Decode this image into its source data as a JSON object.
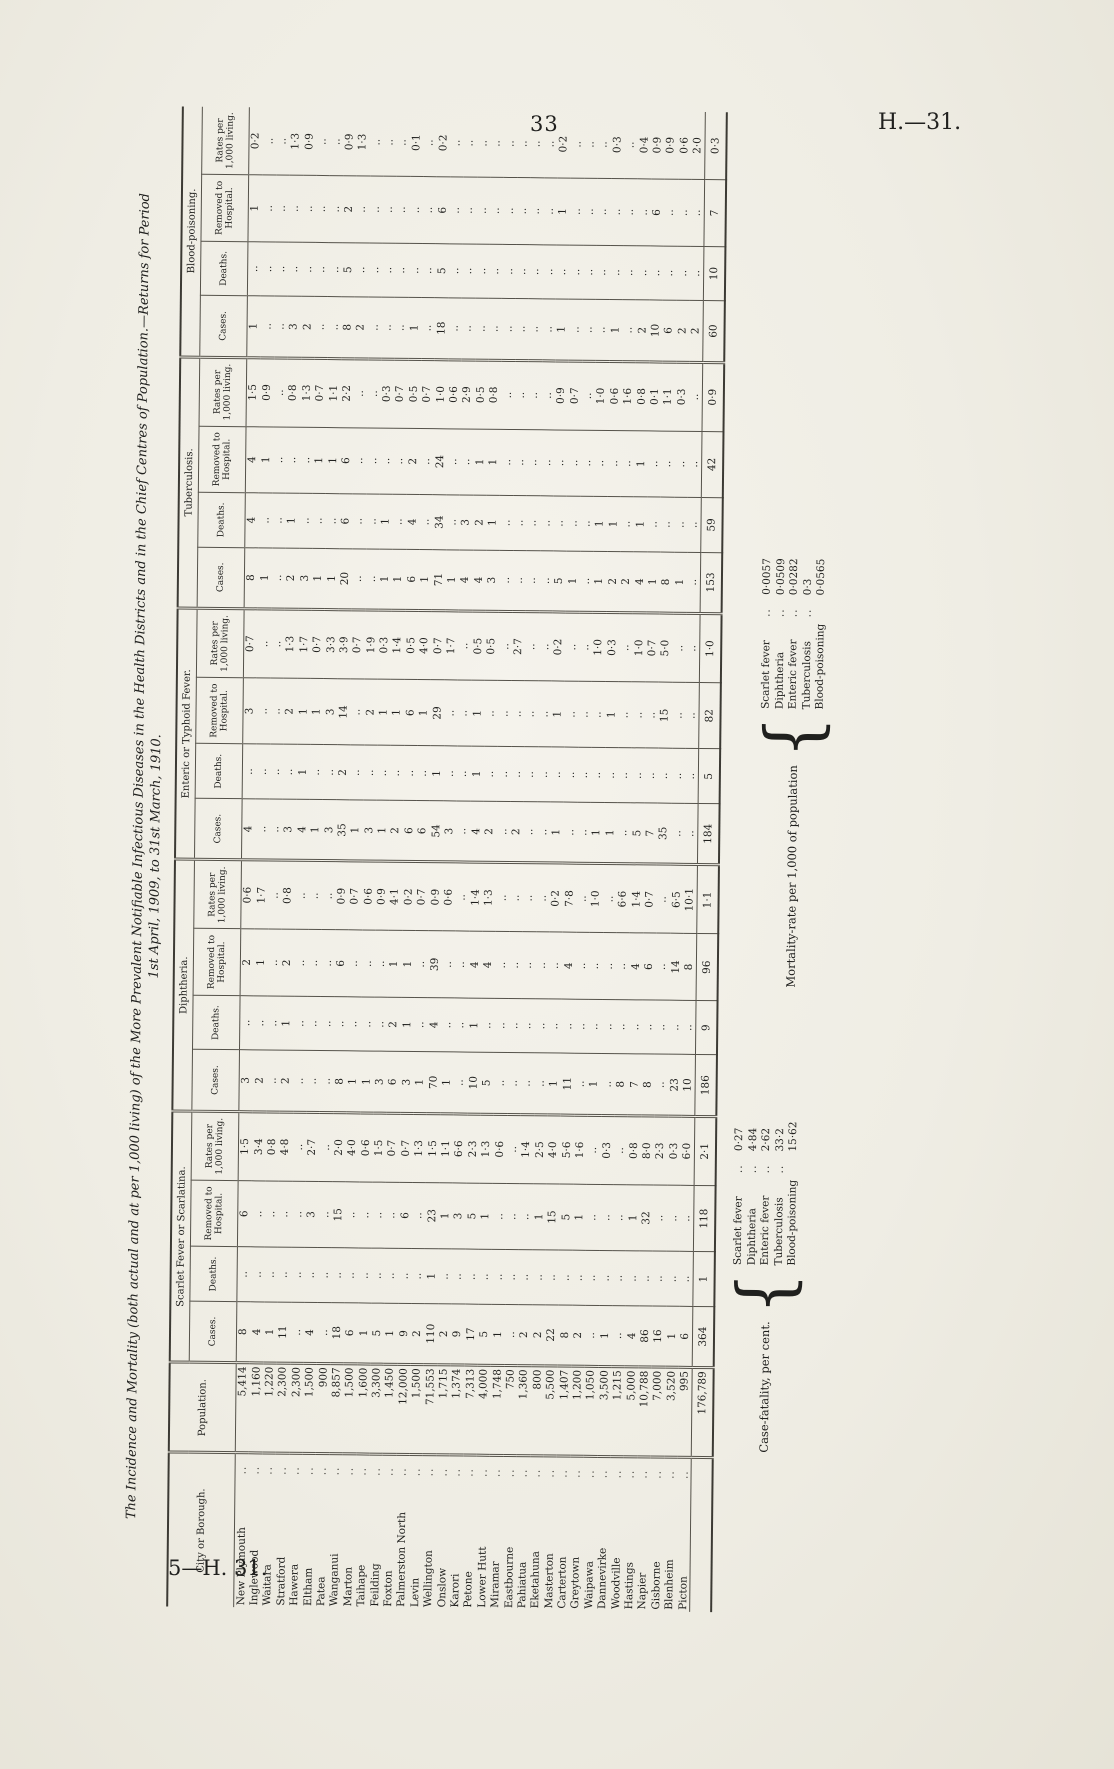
{
  "page": {
    "number": "33",
    "doc_ref": "H.—31.",
    "footer_ref": "5—H. 31."
  },
  "title": {
    "line1": "The Incidence and Mortality (both actual and at per 1,000 living) of the More Prevalent Notifiable Infectious Diseases in the Health Districts and in the Chief Centres of Population.—Returns for Period",
    "line2": "1st April, 1909, to 31st March, 1910."
  },
  "table": {
    "col_headers": {
      "city": "City or Borough.",
      "population": "Population."
    },
    "disease_groups": [
      "Scarlet Fever or Scarlatina.",
      "Diphtheria.",
      "Enteric or Typhoid Fever.",
      "Tuberculosis.",
      "Blood-poisoning."
    ],
    "sub_headers": [
      "Cases.",
      "Deaths.",
      "Removed to Hospital.",
      "Rates per 1,000 living."
    ],
    "leader_dots": "..",
    "blank_marker": "..",
    "rows": [
      {
        "city": "New Plymouth",
        "population": "5,414",
        "values": [
          "8",
          "..",
          "6",
          "1·5",
          "3",
          "..",
          "2",
          "0·6",
          "4",
          "..",
          "3",
          "0·7",
          "8",
          "4",
          "4",
          "1·5",
          "1",
          "..",
          "1",
          "0·2"
        ]
      },
      {
        "city": "Inglewood",
        "population": "1,160",
        "values": [
          "4",
          "..",
          "..",
          "3·4",
          "2",
          "..",
          "1",
          "1·7",
          "..",
          "..",
          "..",
          "..",
          "1",
          "..",
          "1",
          "0·9",
          "..",
          "..",
          "..",
          ".."
        ]
      },
      {
        "city": "Waitara",
        "population": "1,220",
        "values": [
          "1",
          "..",
          "..",
          "0·8",
          "..",
          "..",
          "..",
          "..",
          "..",
          "..",
          "..",
          "..",
          "..",
          "..",
          "..",
          "..",
          "..",
          "..",
          "..",
          ".."
        ]
      },
      {
        "city": "Stratford",
        "population": "2,300",
        "values": [
          "11",
          "..",
          "..",
          "4·8",
          "2",
          "1",
          "2",
          "0·8",
          "3",
          "..",
          "2",
          "1·3",
          "2",
          "1",
          "..",
          "0·8",
          "3",
          "..",
          "..",
          "1·3"
        ]
      },
      {
        "city": "Hawera",
        "population": "2,300",
        "values": [
          "..",
          "..",
          "..",
          "..",
          "..",
          "..",
          "..",
          "..",
          "4",
          "1",
          "1",
          "1·7",
          "3",
          "..",
          "..",
          "1·3",
          "2",
          "..",
          "..",
          "0·9"
        ]
      },
      {
        "city": "Eltham",
        "population": "1,500",
        "values": [
          "4",
          "..",
          "3",
          "2·7",
          "..",
          "..",
          "..",
          "..",
          "1",
          "..",
          "1",
          "0·7",
          "1",
          "..",
          "1",
          "0·7",
          "..",
          "..",
          "..",
          ".."
        ]
      },
      {
        "city": "Patea",
        "population": "900",
        "values": [
          "..",
          "..",
          "..",
          "..",
          "..",
          "..",
          "..",
          "..",
          "3",
          "..",
          "3",
          "3·3",
          "1",
          "..",
          "1",
          "1·1",
          "..",
          "..",
          "..",
          ".."
        ]
      },
      {
        "city": "Wanganui",
        "population": "8,857",
        "values": [
          "18",
          "..",
          "15",
          "2·0",
          "8",
          "..",
          "6",
          "0·9",
          "35",
          "2",
          "14",
          "3·9",
          "20",
          "6",
          "6",
          "2·2",
          "8",
          "5",
          "2",
          "0·9"
        ]
      },
      {
        "city": "Marton",
        "population": "1,500",
        "values": [
          "6",
          "..",
          "..",
          "4·0",
          "1",
          "..",
          "..",
          "0·7",
          "1",
          "..",
          "..",
          "0·7",
          "..",
          "..",
          "..",
          "..",
          "2",
          "..",
          "..",
          "1·3"
        ]
      },
      {
        "city": "Taihape",
        "population": "1,600",
        "values": [
          "1",
          "..",
          "..",
          "0·6",
          "1",
          "..",
          "..",
          "0·6",
          "3",
          "..",
          "2",
          "1·9",
          "..",
          "..",
          "..",
          "..",
          "..",
          "..",
          "..",
          ".."
        ]
      },
      {
        "city": "Feilding",
        "population": "3,300",
        "values": [
          "5",
          "..",
          "..",
          "1·5",
          "3",
          "..",
          "..",
          "0·9",
          "1",
          "..",
          "1",
          "0·3",
          "1",
          "1",
          "..",
          "0·3",
          "..",
          "..",
          "..",
          ".."
        ]
      },
      {
        "city": "Foxton",
        "population": "1,450",
        "values": [
          "1",
          "..",
          "..",
          "0·7",
          "6",
          "2",
          "1",
          "4·1",
          "2",
          "..",
          "1",
          "1·4",
          "1",
          "..",
          "..",
          "0·7",
          "..",
          "..",
          "..",
          ".."
        ]
      },
      {
        "city": "Palmerston North",
        "population": "12,000",
        "values": [
          "9",
          "..",
          "6",
          "0·7",
          "3",
          "1",
          "1",
          "0·2",
          "6",
          "..",
          "6",
          "0·5",
          "6",
          "4",
          "2",
          "0·5",
          "1",
          "..",
          "..",
          "0·1"
        ]
      },
      {
        "city": "Levin",
        "population": "1,500",
        "values": [
          "2",
          "..",
          "..",
          "1·3",
          "1",
          "..",
          "..",
          "0·7",
          "6",
          "..",
          "1",
          "4·0",
          "1",
          "..",
          "..",
          "0·7",
          "..",
          "..",
          "..",
          ".."
        ]
      },
      {
        "city": "Wellington",
        "population": "71,553",
        "values": [
          "110",
          "1",
          "23",
          "1·5",
          "70",
          "4",
          "39",
          "0·9",
          "54",
          "1",
          "29",
          "0·7",
          "71",
          "34",
          "24",
          "1·0",
          "18",
          "5",
          "6",
          "0·2"
        ]
      },
      {
        "city": "Onslow",
        "population": "1,715",
        "values": [
          "2",
          "..",
          "1",
          "1·1",
          "1",
          "..",
          "..",
          "0·6",
          "3",
          "..",
          "..",
          "1·7",
          "1",
          "..",
          "..",
          "0·6",
          "..",
          "..",
          "..",
          ".."
        ]
      },
      {
        "city": "Karori",
        "population": "1,374",
        "values": [
          "9",
          "..",
          "3",
          "6·6",
          "..",
          "..",
          "..",
          "..",
          "..",
          "..",
          "..",
          "..",
          "4",
          "3",
          "..",
          "2·9",
          "..",
          "..",
          "..",
          ".."
        ]
      },
      {
        "city": "Petone",
        "population": "7,313",
        "values": [
          "17",
          "..",
          "5",
          "2·3",
          "10",
          "1",
          "4",
          "1·4",
          "4",
          "1",
          "1",
          "0·5",
          "4",
          "2",
          "1",
          "0·5",
          "..",
          "..",
          "..",
          ".."
        ]
      },
      {
        "city": "Lower Hutt",
        "population": "4,000",
        "values": [
          "5",
          "..",
          "1",
          "1·3",
          "5",
          "..",
          "4",
          "1·3",
          "2",
          "..",
          "..",
          "0·5",
          "3",
          "1",
          "1",
          "0·8",
          "..",
          "..",
          "..",
          ".."
        ]
      },
      {
        "city": "Miramar",
        "population": "1,748",
        "values": [
          "1",
          "..",
          "..",
          "0·6",
          "..",
          "..",
          "..",
          "..",
          "..",
          "..",
          "..",
          "..",
          "..",
          "..",
          "..",
          "..",
          "..",
          "..",
          "..",
          ".."
        ]
      },
      {
        "city": "Eastbourne",
        "population": "750",
        "values": [
          "..",
          "..",
          "..",
          "..",
          "..",
          "..",
          "..",
          "..",
          "2",
          "..",
          "..",
          "2·7",
          "..",
          "..",
          "..",
          "..",
          "..",
          "..",
          "..",
          ".."
        ]
      },
      {
        "city": "Pahiatua",
        "population": "1,360",
        "values": [
          "2",
          "..",
          "..",
          "1·4",
          "..",
          "..",
          "..",
          "..",
          "..",
          "..",
          "..",
          "..",
          "..",
          "..",
          "..",
          "..",
          "..",
          "..",
          "..",
          ".."
        ]
      },
      {
        "city": "Eketahuna",
        "population": "800",
        "values": [
          "2",
          "..",
          "1",
          "2·5",
          "..",
          "..",
          "..",
          "..",
          "..",
          "..",
          "..",
          "..",
          "..",
          "..",
          "..",
          "..",
          "..",
          "..",
          "..",
          ".."
        ]
      },
      {
        "city": "Masterton",
        "population": "5,500",
        "values": [
          "22",
          "..",
          "15",
          "4·0",
          "1",
          "..",
          "..",
          "0·2",
          "1",
          "..",
          "1",
          "0·2",
          "5",
          "..",
          "..",
          "0·9",
          "1",
          "..",
          "1",
          "0·2"
        ]
      },
      {
        "city": "Carterton",
        "population": "1,407",
        "values": [
          "8",
          "..",
          "5",
          "5·6",
          "11",
          "..",
          "4",
          "7·8",
          "..",
          "..",
          "..",
          "..",
          "1",
          "..",
          "..",
          "0·7",
          "..",
          "..",
          "..",
          ".."
        ]
      },
      {
        "city": "Greytown",
        "population": "1,200",
        "values": [
          "2",
          "..",
          "1",
          "1·6",
          "..",
          "..",
          "..",
          "..",
          "..",
          "..",
          "..",
          "..",
          "..",
          "..",
          "..",
          "..",
          "..",
          "..",
          "..",
          ".."
        ]
      },
      {
        "city": "Waipawa",
        "population": "1,050",
        "values": [
          "..",
          "..",
          "..",
          "..",
          "1",
          "..",
          "..",
          "1·0",
          "1",
          "..",
          "..",
          "1·0",
          "1",
          "1",
          "..",
          "1·0",
          "..",
          "..",
          "..",
          ".."
        ]
      },
      {
        "city": "Dannevirke",
        "population": "3,500",
        "values": [
          "1",
          "..",
          "..",
          "0·3",
          "..",
          "..",
          "..",
          "..",
          "1",
          "..",
          "1",
          "0·3",
          "2",
          "1",
          "..",
          "0·6",
          "1",
          "..",
          "..",
          "0·3"
        ]
      },
      {
        "city": "Woodville",
        "population": "1,215",
        "values": [
          "..",
          "..",
          "..",
          "..",
          "8",
          "..",
          "..",
          "6·6",
          "..",
          "..",
          "..",
          "..",
          "2",
          "..",
          "..",
          "1·6",
          "..",
          "..",
          "..",
          ".."
        ]
      },
      {
        "city": "Hastings",
        "population": "5,000",
        "values": [
          "4",
          "..",
          "1",
          "0·8",
          "7",
          "..",
          "4",
          "1·4",
          "5",
          "..",
          "..",
          "1·0",
          "4",
          "1",
          "1",
          "0·8",
          "2",
          "..",
          "..",
          "0·4"
        ]
      },
      {
        "city": "Napier",
        "population": "10,788",
        "values": [
          "86",
          "..",
          "32",
          "8·0",
          "8",
          "..",
          "6",
          "0·7",
          "7",
          "..",
          "..",
          "0·7",
          "1",
          "..",
          "..",
          "0·1",
          "10",
          "..",
          "6",
          "0·9"
        ]
      },
      {
        "city": "Gisborne",
        "population": "7,000",
        "values": [
          "16",
          "..",
          "..",
          "2·3",
          "..",
          "..",
          "..",
          "..",
          "35",
          "..",
          "15",
          "5·0",
          "8",
          "..",
          "..",
          "1·1",
          "6",
          "..",
          "..",
          "0·9"
        ]
      },
      {
        "city": "Blenheim",
        "population": "3,520",
        "values": [
          "1",
          "..",
          "..",
          "0·3",
          "23",
          "..",
          "14",
          "6·5",
          "..",
          "..",
          "..",
          "..",
          "1",
          "..",
          "..",
          "0·3",
          "2",
          "..",
          "..",
          "0·6"
        ]
      },
      {
        "city": "Picton",
        "population": "995",
        "values": [
          "6",
          "..",
          "..",
          "6·0",
          "10",
          "..",
          "8",
          "10·1",
          "..",
          "..",
          "..",
          "..",
          "..",
          "..",
          "..",
          "..",
          "2",
          "..",
          "..",
          "2·0"
        ]
      }
    ],
    "totals": {
      "population": "176,789",
      "values": [
        "364",
        "1",
        "118",
        "2·1",
        "186",
        "9",
        "96",
        "1·1",
        "184",
        "5",
        "82",
        "1·0",
        "153",
        "59",
        "42",
        "0·9",
        "60",
        "10",
        "7",
        "0·3"
      ]
    }
  },
  "notes": {
    "case_fatality": {
      "label": "Case-fatality, per cent.",
      "items": [
        {
          "disease": "Scarlet fever",
          "dots": "..",
          "value": "0·27"
        },
        {
          "disease": "Diphtheria",
          "dots": "..",
          "value": "4·84"
        },
        {
          "disease": "Enteric fever",
          "dots": "..",
          "value": "2·62"
        },
        {
          "disease": "Tuberculosis",
          "dots": "..",
          "value": "33·2"
        },
        {
          "disease": "Blood-poisoning",
          "dots": "",
          "value": "15·62"
        }
      ]
    },
    "mortality_rate": {
      "label": "Mortality-rate per 1,000 of population",
      "items": [
        {
          "disease": "Scarlet fever",
          "dots": "..",
          "value": "0·0057"
        },
        {
          "disease": "Diphtheria",
          "dots": "..",
          "value": "0·0509"
        },
        {
          "disease": "Enteric fever",
          "dots": "..",
          "value": "0·0282"
        },
        {
          "disease": "Tuberculosis",
          "dots": "..",
          "value": "0·3"
        },
        {
          "disease": "Blood-poisoning",
          "dots": "",
          "value": "0·0565"
        }
      ]
    }
  }
}
